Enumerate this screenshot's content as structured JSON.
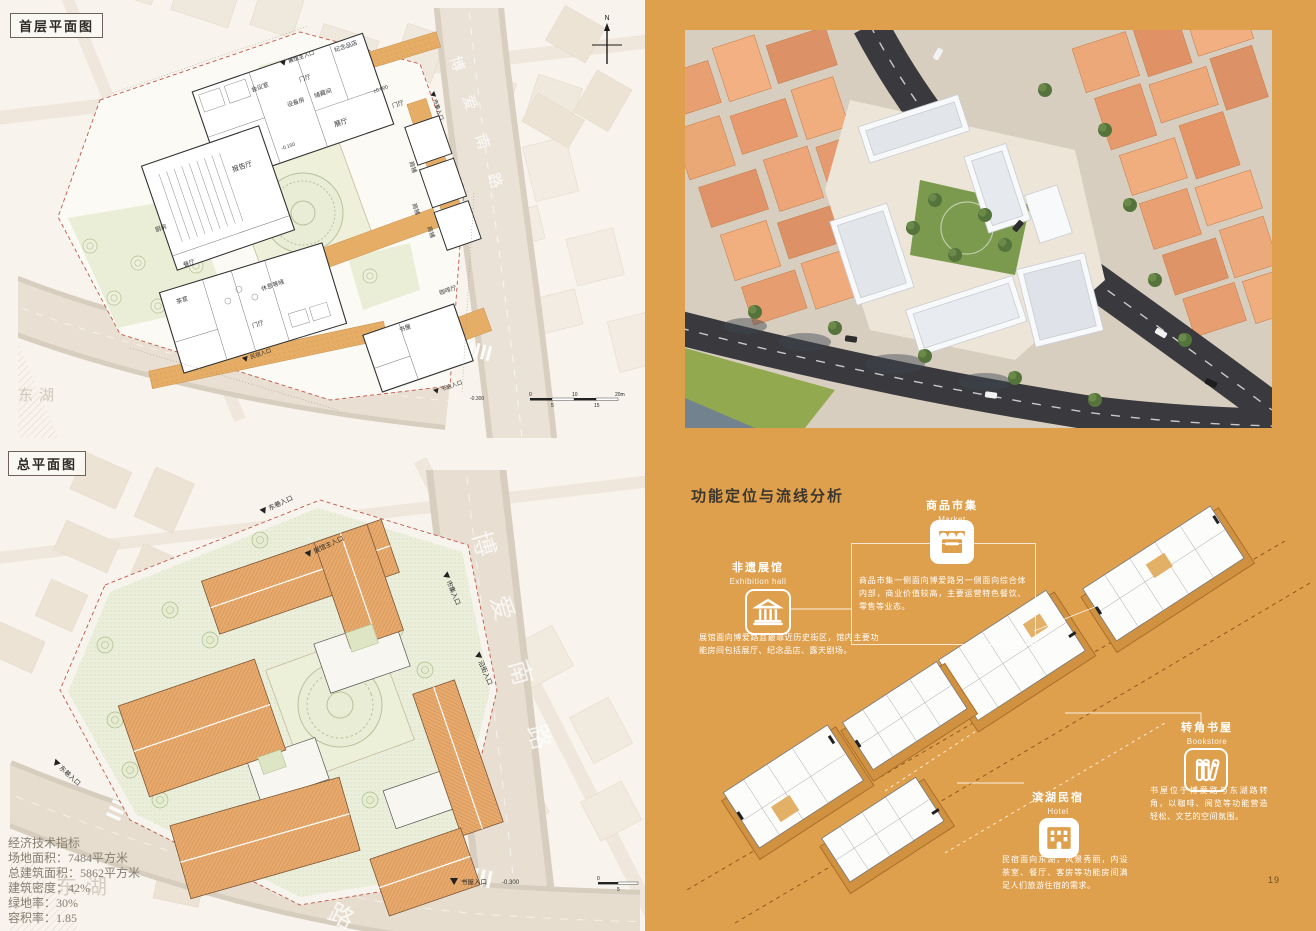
{
  "board": {
    "title_plan1": "首层平面图",
    "title_plan2": "总平面图",
    "page_number": "19"
  },
  "colors": {
    "panel_orange": "#dfa04e",
    "roof_terracotta": "#e7aa6c",
    "plan_path_orange": "#e5ad66",
    "context_block": "#e8a172",
    "road_dark": "#3a393d",
    "ink": "#2f2b26",
    "white": "#ffffff"
  },
  "plan1": {
    "north_label": "N",
    "scale_ticks": [
      "0",
      "5",
      "10",
      "15",
      "20m"
    ],
    "roads": {
      "boai": "博爱南路",
      "donghu_road": "东湖路",
      "lake": "东湖"
    },
    "rooms": [
      "纪念品店",
      "门厅",
      "会议室",
      "储藏间",
      "设备房",
      "展厅",
      "门厅",
      "报告厅",
      "商铺",
      "商铺",
      "商铺",
      "咖啡厅",
      "厨房",
      "餐厅",
      "茶室",
      "休息等候",
      "门厅",
      "书屋"
    ],
    "entrances": [
      "展馆主入口",
      "市集入口",
      "民宿入口",
      "书店入口"
    ],
    "levels": [
      "±0.000",
      "-0.150",
      "-0.300"
    ]
  },
  "plan2": {
    "roads": {
      "boai": "博爱南路",
      "donghu_road": "东湖路",
      "lake": "东湖"
    },
    "entrances": [
      "东巷入口",
      "展馆主入口",
      "市集入口",
      "沿街入口",
      "东巷入口",
      "书屋入口"
    ],
    "level": "-0.300",
    "scale_ticks": [
      "0",
      "5"
    ]
  },
  "stats": {
    "lines": [
      "经济技术指标",
      "场地面积：7484平方米",
      "总建筑面积：5862平方米",
      "建筑密度：42%",
      "绿地率：30%",
      "容积率：1.85"
    ]
  },
  "analysis": {
    "heading": "功能定位与流线分析",
    "functions": {
      "market": {
        "name": "商品市集",
        "en": "Market",
        "icon": "market-stall-icon",
        "desc": "商品市集一侧面向博爱路另一侧面向综合体内部，商业价值较高，主要运营特色餐饮、零售等业态。"
      },
      "exhibition": {
        "name": "非遗展馆",
        "en": "Exhibition hall",
        "icon": "museum-icon",
        "desc": "展馆面向博爱路且最靠近历史街区，馆内主要功能房间包括展厅、纪念品店、露天剧场。"
      },
      "bookstore": {
        "name": "转角书屋",
        "en": "Bookstore",
        "icon": "books-icon",
        "desc": "书屋位于博爱路与东湖路转角，以咖啡、阅览等功能营造轻松、文艺的空间氛围。"
      },
      "hotel": {
        "name": "滨湖民宿",
        "en": "Hotel",
        "icon": "hotel-building-icon",
        "desc": "民宿面向东湖，风景秀丽，内设茶室、餐厅、客房等功能房间满足人们旅游住宿的需求。"
      }
    }
  }
}
